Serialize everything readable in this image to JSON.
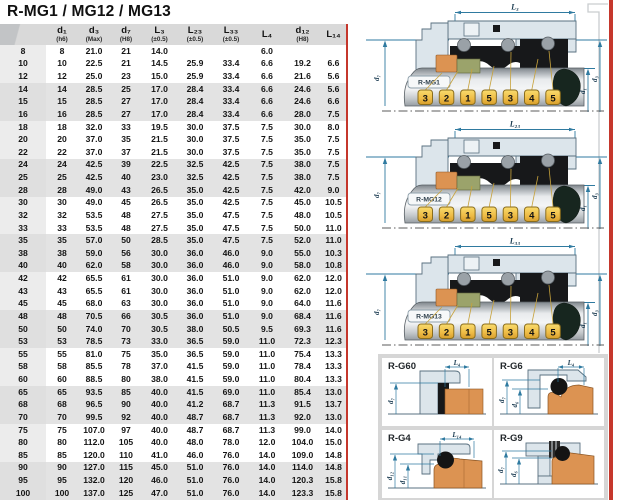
{
  "title": "R-MG1 / MG12 / MG13",
  "table": {
    "columns": [
      {
        "label": "",
        "sub": ""
      },
      {
        "label": "d₁",
        "sub": "(h6)"
      },
      {
        "label": "d₃",
        "sub": "(Max)"
      },
      {
        "label": "d₇",
        "sub": "(H8)"
      },
      {
        "label": "L₃",
        "sub": "(±0.5)"
      },
      {
        "label": "L₂₃",
        "sub": "(±0.5)"
      },
      {
        "label": "L₃₃",
        "sub": "(±0.5)"
      },
      {
        "label": "L₄",
        "sub": ""
      },
      {
        "label": "d₁₂",
        "sub": "(H8)"
      },
      {
        "label": "L₁₄",
        "sub": ""
      }
    ],
    "rows": [
      [
        "8",
        "8",
        "21.0",
        "21",
        "14.0",
        "",
        "",
        "6.0",
        "",
        ""
      ],
      [
        "10",
        "10",
        "22.5",
        "21",
        "14.5",
        "25.9",
        "33.4",
        "6.6",
        "19.2",
        "6.6"
      ],
      [
        "12",
        "12",
        "25.0",
        "23",
        "15.0",
        "25.9",
        "33.4",
        "6.6",
        "21.6",
        "5.6"
      ],
      [
        "14",
        "14",
        "28.5",
        "25",
        "17.0",
        "28.4",
        "33.4",
        "6.6",
        "24.6",
        "5.6"
      ],
      [
        "15",
        "15",
        "28.5",
        "27",
        "17.0",
        "28.4",
        "33.4",
        "6.6",
        "24.6",
        "6.6"
      ],
      [
        "16",
        "16",
        "28.5",
        "27",
        "17.0",
        "28.4",
        "33.4",
        "6.6",
        "28.0",
        "7.5"
      ],
      [
        "18",
        "18",
        "32.0",
        "33",
        "19.5",
        "30.0",
        "37.5",
        "7.5",
        "30.0",
        "8.0"
      ],
      [
        "20",
        "20",
        "37.0",
        "35",
        "21.5",
        "30.0",
        "37.5",
        "7.5",
        "35.0",
        "7.5"
      ],
      [
        "22",
        "22",
        "37.0",
        "37",
        "21.5",
        "30.0",
        "37.5",
        "7.5",
        "35.0",
        "7.5"
      ],
      [
        "24",
        "24",
        "42.5",
        "39",
        "22.5",
        "32.5",
        "42.5",
        "7.5",
        "38.0",
        "7.5"
      ],
      [
        "25",
        "25",
        "42.5",
        "40",
        "23.0",
        "32.5",
        "42.5",
        "7.5",
        "38.0",
        "7.5"
      ],
      [
        "28",
        "28",
        "49.0",
        "43",
        "26.5",
        "35.0",
        "42.5",
        "7.5",
        "42.0",
        "9.0"
      ],
      [
        "30",
        "30",
        "49.0",
        "45",
        "26.5",
        "35.0",
        "42.5",
        "7.5",
        "45.0",
        "10.5"
      ],
      [
        "32",
        "32",
        "53.5",
        "48",
        "27.5",
        "35.0",
        "47.5",
        "7.5",
        "48.0",
        "10.5"
      ],
      [
        "33",
        "33",
        "53.5",
        "48",
        "27.5",
        "35.0",
        "47.5",
        "7.5",
        "50.0",
        "11.0"
      ],
      [
        "35",
        "35",
        "57.0",
        "50",
        "28.5",
        "35.0",
        "47.5",
        "7.5",
        "52.0",
        "11.0"
      ],
      [
        "38",
        "38",
        "59.0",
        "56",
        "30.0",
        "36.0",
        "46.0",
        "9.0",
        "55.0",
        "10.3"
      ],
      [
        "40",
        "40",
        "62.0",
        "58",
        "30.0",
        "36.0",
        "46.0",
        "9.0",
        "58.0",
        "10.8"
      ],
      [
        "42",
        "42",
        "65.5",
        "61",
        "30.0",
        "36.0",
        "51.0",
        "9.0",
        "62.0",
        "12.0"
      ],
      [
        "43",
        "43",
        "65.5",
        "61",
        "30.0",
        "36.0",
        "51.0",
        "9.0",
        "62.0",
        "12.0"
      ],
      [
        "45",
        "45",
        "68.0",
        "63",
        "30.0",
        "36.0",
        "51.0",
        "9.0",
        "64.0",
        "11.6"
      ],
      [
        "48",
        "48",
        "70.5",
        "66",
        "30.5",
        "36.0",
        "51.0",
        "9.0",
        "68.4",
        "11.6"
      ],
      [
        "50",
        "50",
        "74.0",
        "70",
        "30.5",
        "38.0",
        "50.5",
        "9.5",
        "69.3",
        "11.6"
      ],
      [
        "53",
        "53",
        "78.5",
        "73",
        "33.0",
        "36.5",
        "59.0",
        "11.0",
        "72.3",
        "12.3"
      ],
      [
        "55",
        "55",
        "81.0",
        "75",
        "35.0",
        "36.5",
        "59.0",
        "11.0",
        "75.4",
        "13.3"
      ],
      [
        "58",
        "58",
        "85.5",
        "78",
        "37.0",
        "41.5",
        "59.0",
        "11.0",
        "78.4",
        "13.3"
      ],
      [
        "60",
        "60",
        "88.5",
        "80",
        "38.0",
        "41.5",
        "59.0",
        "11.0",
        "80.4",
        "13.3"
      ],
      [
        "65",
        "65",
        "93.5",
        "85",
        "40.0",
        "41.5",
        "69.0",
        "11.0",
        "85.4",
        "13.0"
      ],
      [
        "68",
        "68",
        "96.5",
        "90",
        "40.0",
        "41.2",
        "68.7",
        "11.3",
        "91.5",
        "13.7"
      ],
      [
        "70",
        "70",
        "99.5",
        "92",
        "40.0",
        "48.7",
        "68.7",
        "11.3",
        "92.0",
        "13.0"
      ],
      [
        "75",
        "75",
        "107.0",
        "97",
        "40.0",
        "48.7",
        "68.7",
        "11.3",
        "99.0",
        "14.0"
      ],
      [
        "80",
        "80",
        "112.0",
        "105",
        "40.0",
        "48.0",
        "78.0",
        "12.0",
        "104.0",
        "15.0"
      ],
      [
        "85",
        "85",
        "120.0",
        "110",
        "41.0",
        "46.0",
        "76.0",
        "14.0",
        "109.0",
        "14.8"
      ],
      [
        "90",
        "90",
        "127.0",
        "115",
        "45.0",
        "51.0",
        "76.0",
        "14.0",
        "114.0",
        "14.8"
      ],
      [
        "95",
        "95",
        "132.0",
        "120",
        "46.0",
        "51.0",
        "76.0",
        "14.0",
        "120.3",
        "15.8"
      ],
      [
        "100",
        "100",
        "137.0",
        "125",
        "47.0",
        "51.0",
        "76.0",
        "14.0",
        "123.3",
        "15.8"
      ]
    ]
  },
  "seal_diagrams": [
    {
      "name": "R-MG1",
      "dim_label": "L₃",
      "callouts": [
        "3",
        "2",
        "1",
        "5",
        "3",
        "4",
        "5"
      ],
      "dims": {
        "left": "d₇",
        "inner": "d₁",
        "outer": "d₃"
      }
    },
    {
      "name": "R-MG12",
      "dim_label": "L₂₃",
      "callouts": [
        "3",
        "2",
        "1",
        "5",
        "3",
        "4",
        "5"
      ],
      "dims": {
        "left": "d₇",
        "inner": "d₁",
        "outer": "d₃"
      }
    },
    {
      "name": "R-MG13",
      "dim_label": "L₃₃",
      "callouts": [
        "3",
        "2",
        "1",
        "5",
        "3",
        "4",
        "5"
      ],
      "dims": {
        "left": "d₇",
        "inner": "d₁",
        "outer": "d₃"
      }
    }
  ],
  "seat_diagrams": [
    {
      "name": "R-G60",
      "dim_top": "L₄",
      "dims_left": [
        "d₇"
      ]
    },
    {
      "name": "R-G6",
      "dim_top": "L₄",
      "dims_left": [
        "d₇",
        "d₆"
      ]
    },
    {
      "name": "R-G4",
      "dim_top": "L₁₄",
      "dims_left": [
        "d₁₂",
        "d₁₁"
      ]
    },
    {
      "name": "R-G9",
      "dims_left": [
        "d₇",
        "d₆"
      ]
    }
  ],
  "colors": {
    "accent_red": "#c5372c",
    "callout_gold": "#f2c24a",
    "part_orange": "#dc9352",
    "part_olive": "#9ba36b",
    "housing_blue": "#dce5eb",
    "dimension_blue": "#2f7aa0"
  }
}
